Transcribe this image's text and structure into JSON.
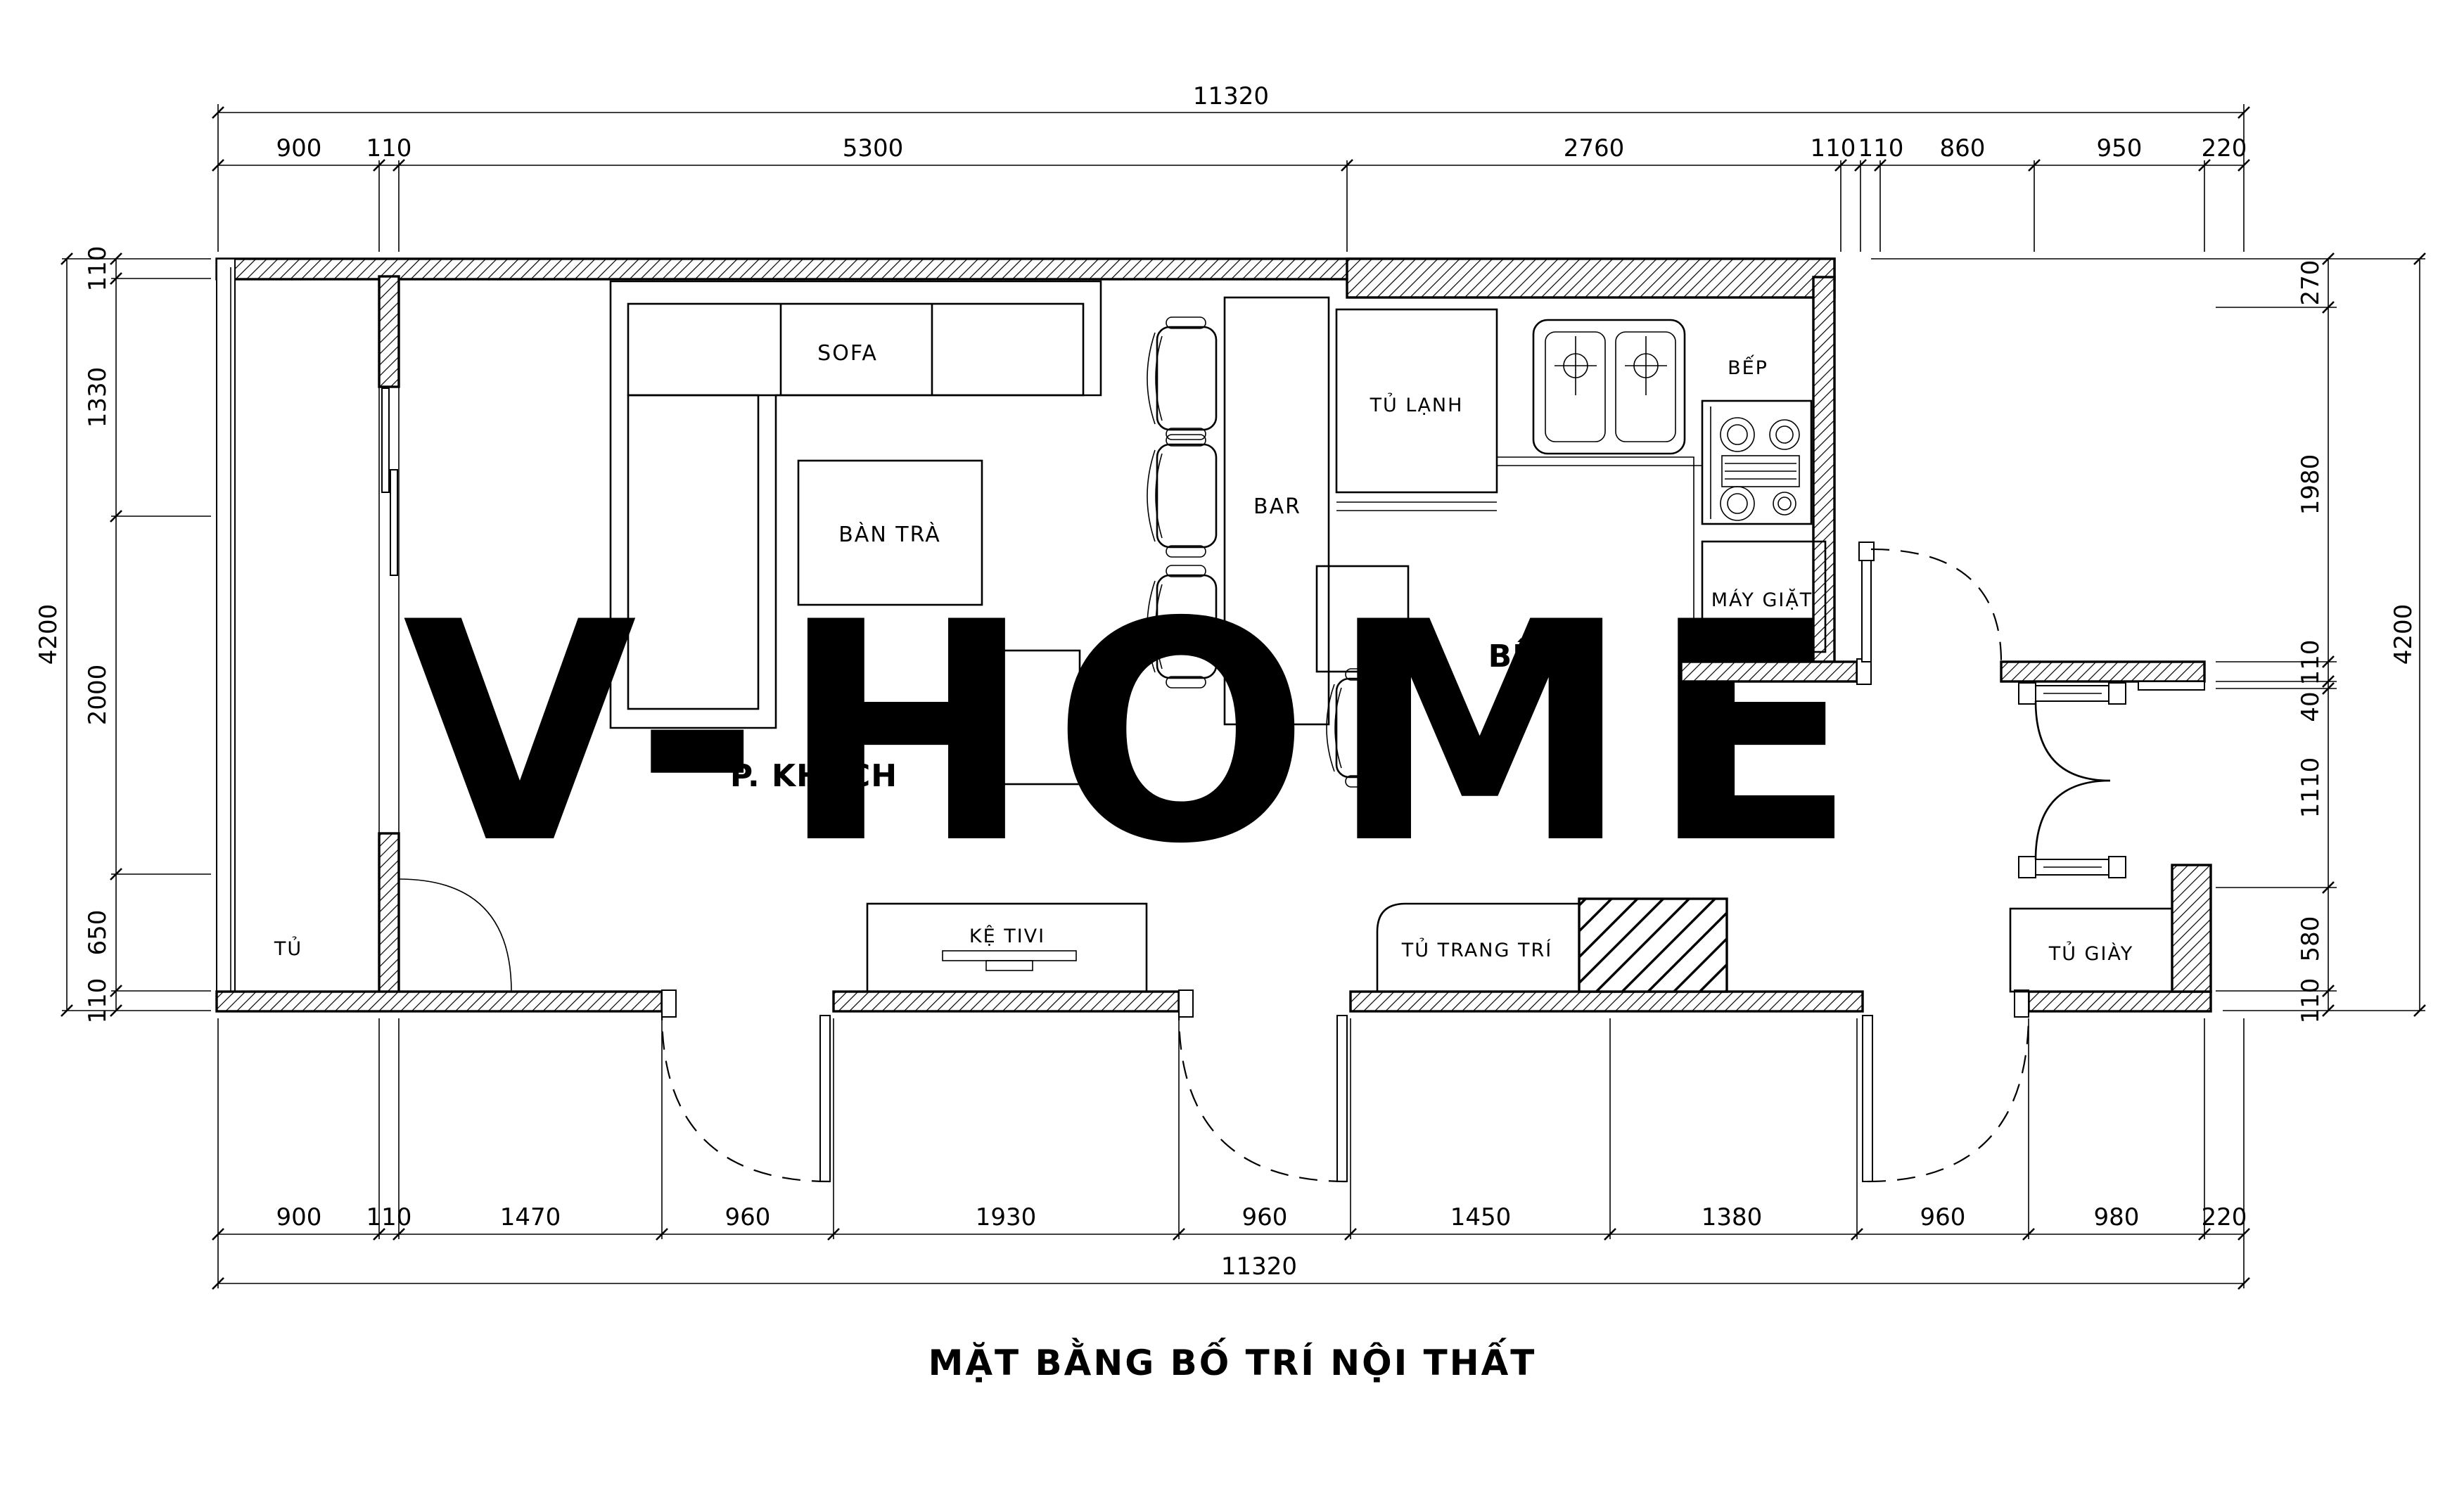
{
  "title": "MẶT BẰNG BỐ TRÍ NỘI THẤT",
  "watermark": {
    "text": "V-HOME",
    "color": "#FAE7C6"
  },
  "rooms": {
    "living": "P. KHÁCH",
    "kitchen": "BẾP"
  },
  "furniture": {
    "sofa": "SOFA",
    "coffee_table": "BÀN TRÀ",
    "bar": "BAR",
    "fridge": "TỦ LẠNH",
    "stove_area": "BẾP",
    "washer": "MÁY GIẶT",
    "closet": "TỦ",
    "tv_shelf": "KỆ TIVI",
    "deco_cabinet": "TỦ TRANG TRÍ",
    "shoe_cabinet": "TỦ GIÀY"
  },
  "dims": {
    "top_total": "11320",
    "bottom_total": "11320",
    "left_total": "4200",
    "right_total": "4200",
    "top": [
      "900",
      "110",
      "5300",
      "2760",
      "110",
      "110",
      "860",
      "950",
      "220"
    ],
    "bottom": [
      "900",
      "110",
      "1470",
      "960",
      "1930",
      "960",
      "1450",
      "1380",
      "960",
      "980",
      "220"
    ],
    "left": [
      "110",
      "1330",
      "2000",
      "650",
      "110"
    ],
    "right": [
      "270",
      "1980",
      "110",
      "40",
      "1110",
      "580",
      "110"
    ]
  },
  "line_color": "#000000"
}
